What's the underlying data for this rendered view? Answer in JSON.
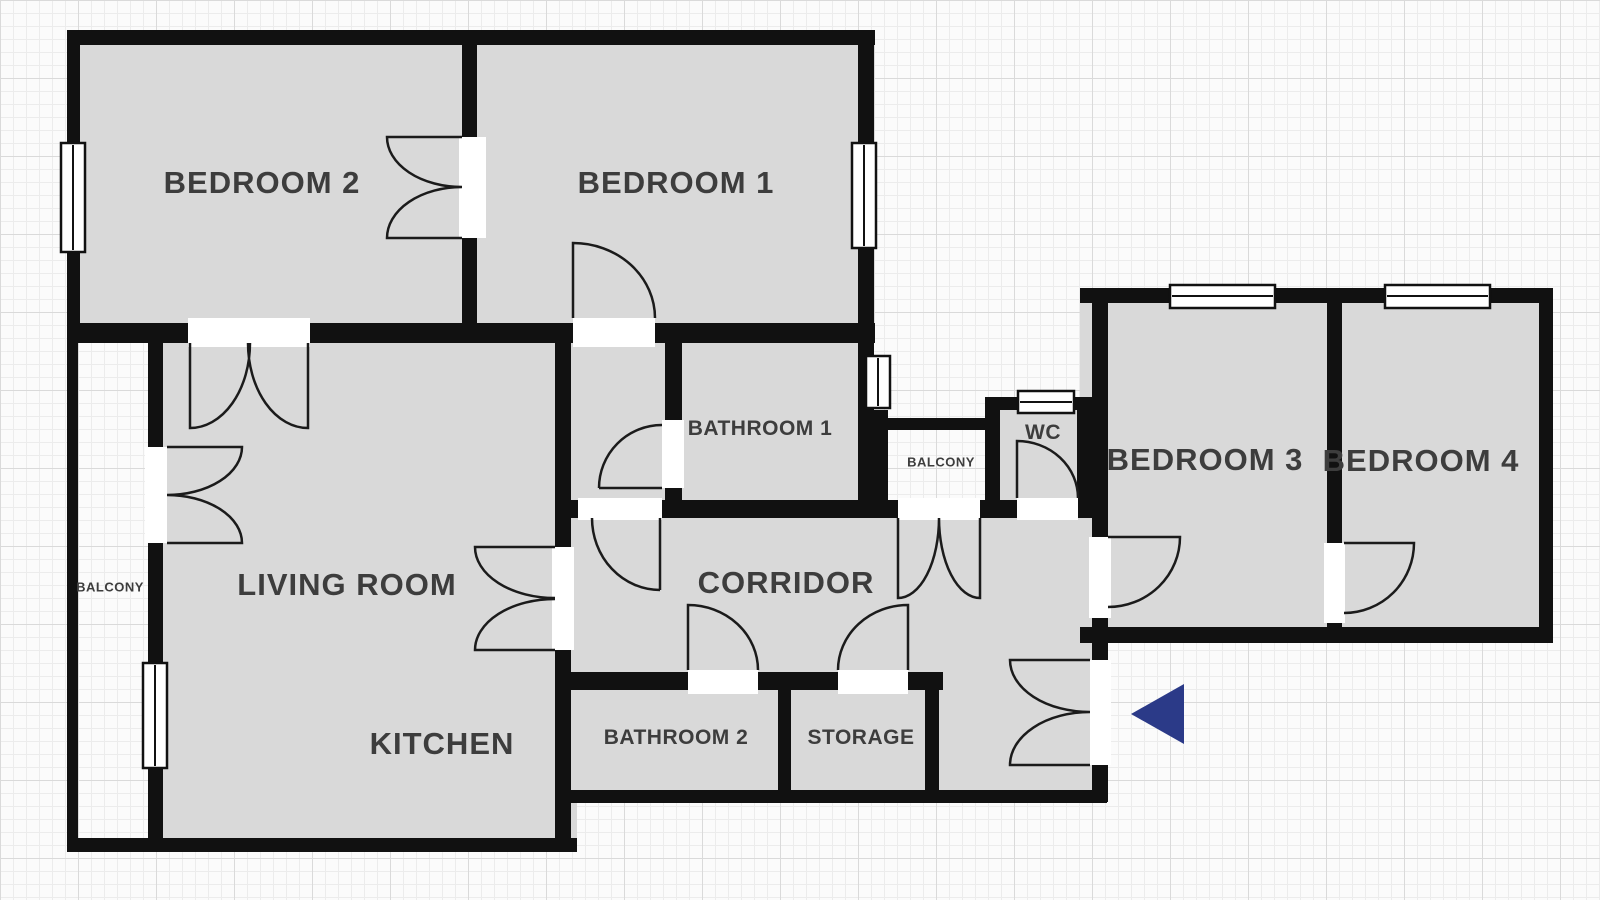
{
  "plan": {
    "type": "apartment-floor-plan",
    "colors": {
      "wall": "#111111",
      "room_fill": "#d9d9d9",
      "label_text": "#3d3d3d",
      "window_fill": "#ffffff",
      "grid_fine": "#ececec",
      "grid_major": "#dadada",
      "background": "#fbfbfb"
    },
    "rooms": [
      {
        "id": "bedroom-2",
        "label": "BEDROOM 2"
      },
      {
        "id": "bedroom-1",
        "label": "BEDROOM 1"
      },
      {
        "id": "bathroom-1",
        "label": "BATHROOM 1"
      },
      {
        "id": "balcony-middle",
        "label": "BALCONY"
      },
      {
        "id": "wc",
        "label": "WC"
      },
      {
        "id": "bedroom-3",
        "label": "BEDROOM 3"
      },
      {
        "id": "bedroom-4",
        "label": "BEDROOM 4"
      },
      {
        "id": "living-room",
        "label": "LIVING ROOM"
      },
      {
        "id": "corridor",
        "label": "CORRIDOR"
      },
      {
        "id": "kitchen",
        "label": "KITCHEN"
      },
      {
        "id": "bathroom-2",
        "label": "BATHROOM 2"
      },
      {
        "id": "storage",
        "label": "STORAGE"
      },
      {
        "id": "balcony-left",
        "label": "BALCONY"
      }
    ],
    "entrance": {
      "icon": "entrance-arrow",
      "direction": "left",
      "color": "#2b3a88"
    }
  }
}
